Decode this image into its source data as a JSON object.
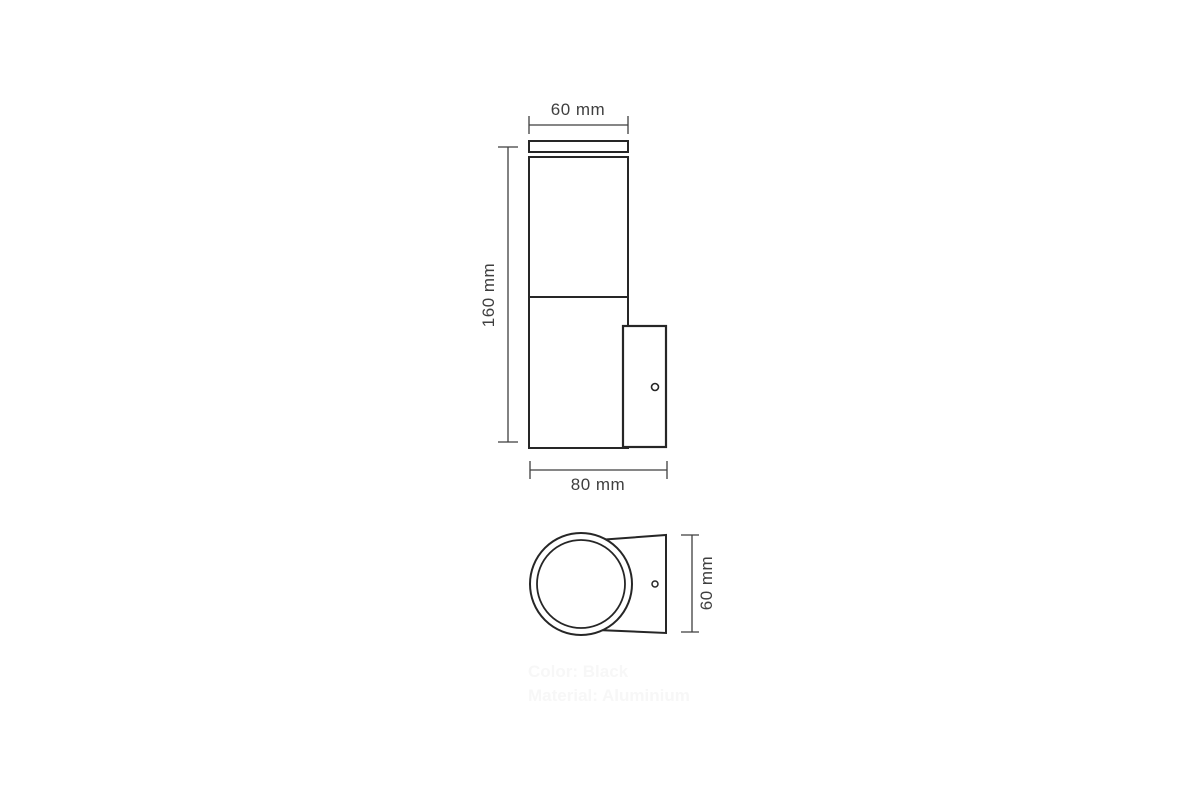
{
  "front_view": {
    "top_width_label": "60 mm",
    "height_label": "160 mm",
    "bottom_width_label": "80 mm"
  },
  "bottom_view": {
    "depth_label": "60 mm"
  },
  "notes": {
    "color": "Color: Black",
    "material": "Material: Aluminium"
  },
  "colors": {
    "outline": "#262626",
    "dimension": "#3f3f3f",
    "note_text": "#f7f7f7",
    "background": "#ffffff"
  }
}
